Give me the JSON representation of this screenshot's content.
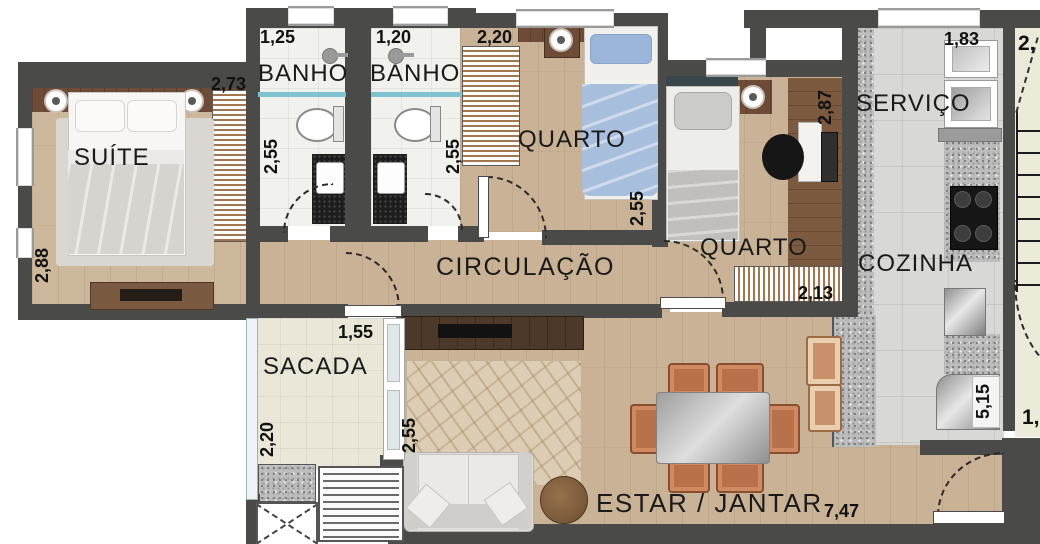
{
  "plan": {
    "rooms": {
      "suite": {
        "name": "SUÍTE",
        "dim_w": "2,73",
        "dim_h": "2,88"
      },
      "banho1": {
        "name": "BANHO",
        "dim_w": "1,25",
        "dim_h": "2,55"
      },
      "banho2": {
        "name": "BANHO",
        "dim_w": "1,20",
        "dim_h": "2,55"
      },
      "closet": {
        "dim_w": "2,20"
      },
      "quarto1": {
        "name": "QUARTO",
        "dim_h": "2,55"
      },
      "quarto2": {
        "name": "QUARTO",
        "dim_h": "2,87",
        "dim_wardrobe": "2,13"
      },
      "servico": {
        "name": "SERVIÇO",
        "dim_w": "1,83"
      },
      "cozinha": {
        "name": "COZINHA",
        "dim_h": "5,15"
      },
      "circulacao": {
        "name": "CIRCULAÇÃO"
      },
      "sacada": {
        "name": "SACADA",
        "dim_w": "1,55",
        "dim_h": "2,20"
      },
      "estar": {
        "name": "ESTAR / JANTAR",
        "dim_w": "7,47",
        "dim_rug": "2,55"
      },
      "exterior": {
        "stair_top_partial": "2,",
        "stair_side_partial": "1,"
      }
    },
    "colors": {
      "wall": "#4a4a48",
      "wood_floor": "#c9b295",
      "bath_tile": "#f1f1ee",
      "kitchen_tile": "#d8d8d6",
      "balcony_tile": "#eae7d8",
      "stair_area": "#ecead9",
      "bed_blue": "#a8bedd",
      "chair_terracotta": "#b9714c",
      "shower_glass_teal": "#7ec3cf",
      "furniture_brown": "#6d4b37"
    }
  }
}
